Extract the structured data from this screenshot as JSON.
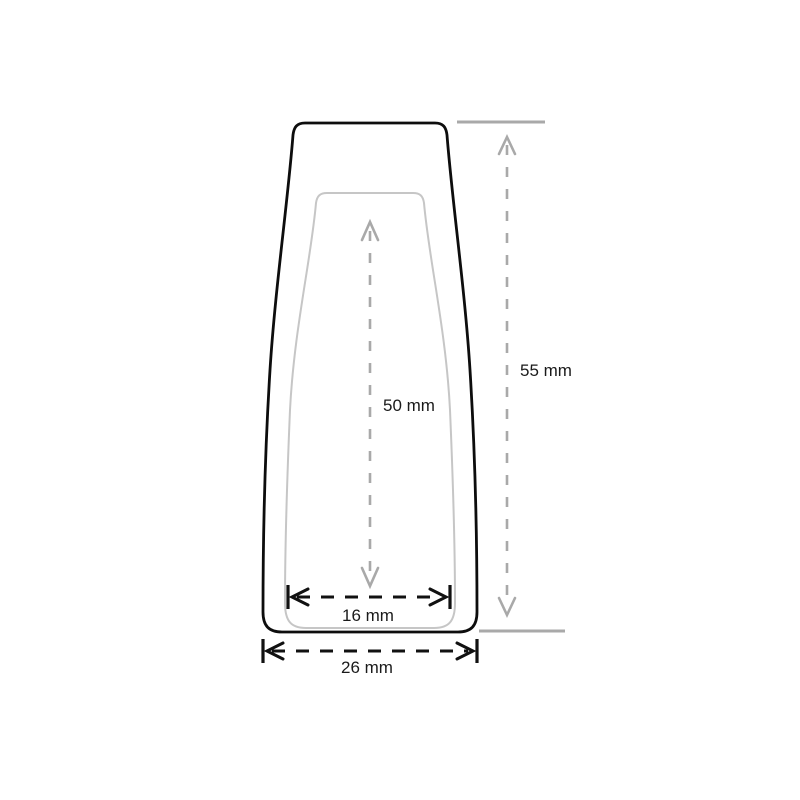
{
  "figure": {
    "type": "technical-drawing",
    "background": "#ffffff"
  },
  "colors": {
    "outline": "#0d0d0d",
    "inner_outline": "#c6c6c6",
    "dimension_gray": "#a9a9a9",
    "dimension_black": "#111111",
    "text": "#1a1a1a"
  },
  "dimensions": {
    "overall_height": {
      "label": "55 mm"
    },
    "inner_height": {
      "label": "50 mm"
    },
    "inner_width": {
      "label": "16 mm"
    },
    "outer_width": {
      "label": "26 mm"
    }
  }
}
